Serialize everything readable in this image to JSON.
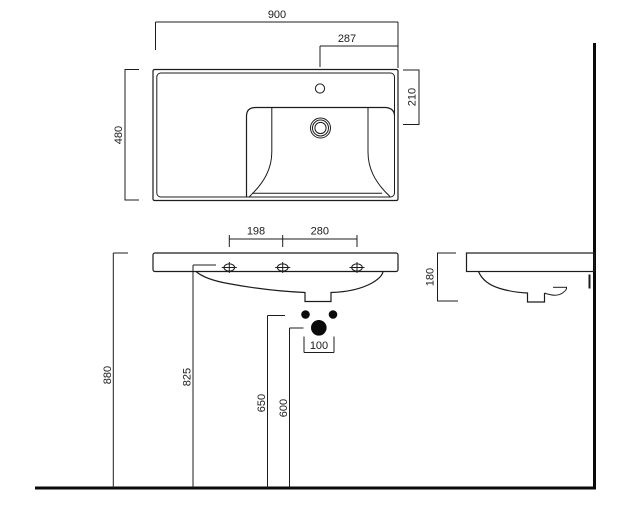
{
  "title": "Wall-mounted washbasin dimension drawing",
  "units": "mm",
  "colors": {
    "line": "#1c1c1c",
    "heavy_line": "#0a0a0a",
    "background": "#ffffff"
  },
  "views": {
    "top": "plan view of basin deck with tap hole and drain",
    "front": "front elevation with fixing holes and waste outlets",
    "side": "side profile against wall with trap"
  },
  "dims": {
    "overall_width": "900",
    "tap_to_right_edge": "287",
    "overall_depth": "480",
    "back_edge_to_drain": "210",
    "hole_spacing_left": "198",
    "hole_spacing_right": "280",
    "basin_height": "180",
    "rim_height": "880",
    "fixing_hole_height": "825",
    "supply_height": "650",
    "waste_height": "600",
    "waste_offset": "100"
  }
}
